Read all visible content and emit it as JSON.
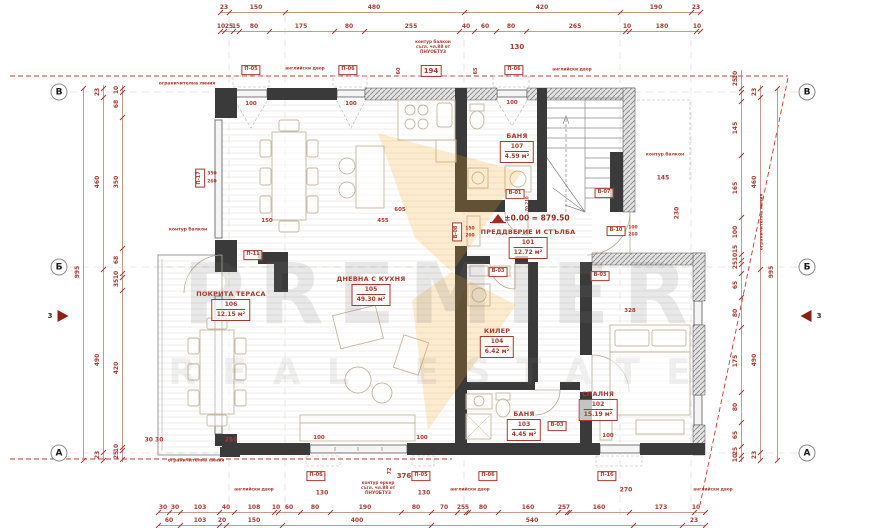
{
  "watermark": {
    "line1": "PREMIER",
    "line2": "REAL ESTATE",
    "accent_color": "#f2a71b"
  },
  "level_mark": "±0.00 = 879.50",
  "rooms": [
    {
      "name": "ПРЕДДВЕРИЕ И СТЪЛБА",
      "number": "101",
      "area": "12.72 м²",
      "x": 528,
      "y": 228
    },
    {
      "name": "СПАЛНЯ",
      "number": "102",
      "area": "15.19 м²",
      "x": 598,
      "y": 390
    },
    {
      "name": "БАНЯ",
      "number": "103",
      "area": "4.45 м²",
      "x": 524,
      "y": 410
    },
    {
      "name": "КИЛЕР",
      "number": "104",
      "area": "6.42 м²",
      "x": 497,
      "y": 327
    },
    {
      "name": "ДНЕВНА С КУХНЯ",
      "number": "105",
      "area": "49.30 м²",
      "x": 371,
      "y": 275
    },
    {
      "name": "ПОКРИТА ТЕРАСА",
      "number": "106",
      "area": "12.15 м²",
      "x": 231,
      "y": 290
    },
    {
      "name": "БАНЯ",
      "number": "107",
      "area": "4.59 м²",
      "x": 517,
      "y": 132
    }
  ],
  "grid_markers": [
    {
      "letter": "В",
      "x": 59,
      "y": 92
    },
    {
      "letter": "Б",
      "x": 59,
      "y": 267
    },
    {
      "letter": "А",
      "x": 59,
      "y": 453
    },
    {
      "letter": "В",
      "x": 807,
      "y": 92
    },
    {
      "letter": "Б",
      "x": 807,
      "y": 267
    },
    {
      "letter": "А",
      "x": 807,
      "y": 453
    }
  ],
  "section_markers": [
    {
      "label": "3",
      "x": 63,
      "y": 316,
      "dir": "right",
      "lx": 50,
      "ly": 316
    },
    {
      "label": "3",
      "x": 806,
      "y": 316,
      "dir": "left",
      "lx": 819,
      "ly": 316
    }
  ],
  "dims": [
    {
      "name": "dim-top-row1",
      "orient": "h",
      "pos": 12,
      "from": 220,
      "to": 700,
      "ticks": [
        220,
        229,
        285,
        464,
        620,
        691,
        700
      ],
      "labels": [
        {
          "p": 224,
          "v": "23"
        },
        {
          "p": 256,
          "v": "150"
        },
        {
          "p": 374,
          "v": "480"
        },
        {
          "p": 542,
          "v": "420"
        },
        {
          "p": 656,
          "v": "190"
        },
        {
          "p": 696,
          "v": "23"
        }
      ]
    },
    {
      "name": "dim-top-row2",
      "orient": "h",
      "pos": 31,
      "from": 220,
      "to": 700,
      "ticks": [
        220,
        224,
        233,
        239,
        269,
        334,
        364,
        459,
        474,
        496,
        526,
        625,
        629,
        696,
        700
      ],
      "labels": [
        {
          "p": 221,
          "v": "10"
        },
        {
          "p": 229,
          "v": "25"
        },
        {
          "p": 236,
          "v": "15"
        },
        {
          "p": 254,
          "v": "80"
        },
        {
          "p": 301,
          "v": "175"
        },
        {
          "p": 349,
          "v": "80"
        },
        {
          "p": 411,
          "v": "255"
        },
        {
          "p": 466,
          "v": "40"
        },
        {
          "p": 485,
          "v": "60"
        },
        {
          "p": 511,
          "v": "80"
        },
        {
          "p": 575,
          "v": "265"
        },
        {
          "p": 627,
          "v": "10"
        },
        {
          "p": 662,
          "v": "180"
        },
        {
          "p": 697,
          "v": "10"
        }
      ]
    },
    {
      "name": "dim-bottom-row1",
      "orient": "h",
      "pos": 512,
      "from": 158,
      "to": 705,
      "ticks": [
        158,
        169,
        180,
        219,
        234,
        274,
        278,
        300,
        330,
        401,
        431,
        457,
        466,
        468,
        498,
        558,
        567,
        569,
        629,
        694,
        705
      ],
      "labels": [
        {
          "p": 163,
          "v": "30"
        },
        {
          "p": 175,
          "v": "30"
        },
        {
          "p": 200,
          "v": "103"
        },
        {
          "p": 226,
          "v": "40"
        },
        {
          "p": 254,
          "v": "108"
        },
        {
          "p": 276,
          "v": "10"
        },
        {
          "p": 289,
          "v": "60"
        },
        {
          "p": 315,
          "v": "80"
        },
        {
          "p": 365,
          "v": "190"
        },
        {
          "p": 416,
          "v": "80"
        },
        {
          "p": 444,
          "v": "70"
        },
        {
          "p": 461,
          "v": "25"
        },
        {
          "p": 467,
          "v": "5"
        },
        {
          "p": 483,
          "v": "80"
        },
        {
          "p": 528,
          "v": "160"
        },
        {
          "p": 562,
          "v": "25"
        },
        {
          "p": 568,
          "v": "7"
        },
        {
          "p": 599,
          "v": "160"
        },
        {
          "p": 661,
          "v": "173"
        },
        {
          "p": 696,
          "v": "10"
        }
      ]
    },
    {
      "name": "dim-bottom-row2",
      "orient": "h",
      "pos": 525,
      "from": 158,
      "to": 705,
      "ticks": [
        158,
        180,
        219,
        226,
        282,
        431,
        633,
        682,
        705
      ],
      "labels": [
        {
          "p": 169,
          "v": "60"
        },
        {
          "p": 200,
          "v": "103"
        },
        {
          "p": 222,
          "v": "20"
        },
        {
          "p": 254,
          "v": "150"
        },
        {
          "p": 357,
          "v": "400"
        },
        {
          "p": 532,
          "v": "540"
        },
        {
          "p": 694,
          "v": "23"
        }
      ]
    },
    {
      "name": "dim-left-total",
      "orient": "v",
      "pos": 83,
      "from": 88,
      "to": 460,
      "ticks": [
        88,
        460
      ],
      "labels": [
        {
          "p": 272,
          "v": "995"
        }
      ]
    },
    {
      "name": "dim-left-mid",
      "orient": "v",
      "pos": 103,
      "from": 85,
      "to": 460,
      "ticks": [
        88,
        97,
        269,
        452,
        460
      ],
      "labels": [
        {
          "p": 92,
          "v": "23"
        },
        {
          "p": 182,
          "v": "460"
        },
        {
          "p": 360,
          "v": "490"
        },
        {
          "p": 455,
          "v": "23"
        }
      ]
    },
    {
      "name": "dim-left-inner",
      "orient": "v",
      "pos": 122,
      "from": 85,
      "to": 462,
      "ticks": [
        88,
        92,
        117,
        248,
        273,
        277,
        290,
        447,
        450,
        459
      ],
      "labels": [
        {
          "p": 90,
          "v": "10"
        },
        {
          "p": 104,
          "v": "68"
        },
        {
          "p": 182,
          "v": "350"
        },
        {
          "p": 260,
          "v": "68"
        },
        {
          "p": 275,
          "v": "10"
        },
        {
          "p": 283,
          "v": "35"
        },
        {
          "p": 368,
          "v": "420"
        },
        {
          "p": 448,
          "v": "10"
        },
        {
          "p": 455,
          "v": "25"
        }
      ]
    },
    {
      "name": "dim-right-inner",
      "orient": "v",
      "pos": 741,
      "from": 70,
      "to": 462,
      "ticks": [
        88,
        92,
        101,
        155,
        217,
        254,
        260,
        264,
        273,
        297,
        327,
        392,
        422,
        446,
        455,
        459
      ],
      "labels": [
        {
          "p": 75,
          "v": "10"
        },
        {
          "p": 82,
          "v": "25"
        },
        {
          "p": 128,
          "v": "145"
        },
        {
          "p": 188,
          "v": "165"
        },
        {
          "p": 232,
          "v": "100"
        },
        {
          "p": 249,
          "v": "15"
        },
        {
          "p": 257,
          "v": "10"
        },
        {
          "p": 265,
          "v": "25"
        },
        {
          "p": 285,
          "v": "65"
        },
        {
          "p": 313,
          "v": "80"
        },
        {
          "p": 361,
          "v": "175"
        },
        {
          "p": 407,
          "v": "80"
        },
        {
          "p": 435,
          "v": "65"
        },
        {
          "p": 451,
          "v": "25"
        },
        {
          "p": 458,
          "v": "10"
        }
      ]
    },
    {
      "name": "dim-right-mid",
      "orient": "v",
      "pos": 760,
      "from": 85,
      "to": 460,
      "ticks": [
        88,
        97,
        269,
        452,
        460
      ],
      "labels": [
        {
          "p": 92,
          "v": "23"
        },
        {
          "p": 182,
          "v": "460"
        },
        {
          "p": 360,
          "v": "490"
        },
        {
          "p": 455,
          "v": "23"
        }
      ]
    },
    {
      "name": "dim-right-total",
      "orient": "v",
      "pos": 777,
      "from": 88,
      "to": 460,
      "ticks": [
        88,
        460
      ],
      "labels": [
        {
          "p": 272,
          "v": "995"
        }
      ]
    }
  ],
  "annotations": [
    {
      "t": "ограничителна линия",
      "x": 187,
      "y": 84,
      "s": 4.5
    },
    {
      "t": "ограничителна линия",
      "x": 196,
      "y": 461,
      "s": 4.5
    },
    {
      "t": "ограничителна линия",
      "x": 762,
      "y": 222,
      "s": 4.5,
      "rot": true
    },
    {
      "t": "контур балкон",
      "x": 188,
      "y": 230,
      "s": 4.5
    },
    {
      "t": "контур балкон",
      "x": 665,
      "y": 155,
      "s": 4.5
    },
    {
      "t": "контур балкон\nсъгл. чл.88 от\nПНУОБТУЗ",
      "x": 433,
      "y": 47,
      "s": 4.2
    },
    {
      "t": "контур еркер\nсъгл. чл.88 от\nПНУОБТУЗ",
      "x": 378,
      "y": 488,
      "s": 4.2
    },
    {
      "t": "английски двор",
      "x": 305,
      "y": 70,
      "s": 4.3
    },
    {
      "t": "английски двор",
      "x": 572,
      "y": 71,
      "s": 4.3
    },
    {
      "t": "английски двор",
      "x": 254,
      "y": 491,
      "s": 4.3
    },
    {
      "t": "английски двор",
      "x": 470,
      "y": 491,
      "s": 4.3
    },
    {
      "t": "английски двор",
      "x": 713,
      "y": 491,
      "s": 4.3
    },
    {
      "t": "±0.00 = 879.50",
      "x": 537,
      "y": 219,
      "s": 7.5,
      "dark": true
    },
    {
      "t": "194",
      "x": 431,
      "y": 71,
      "s": 7,
      "box": true
    },
    {
      "t": "130",
      "x": 517,
      "y": 47,
      "s": 7
    },
    {
      "t": "130",
      "x": 322,
      "y": 494,
      "s": 6
    },
    {
      "t": "130",
      "x": 424,
      "y": 494,
      "s": 6
    },
    {
      "t": "376",
      "x": 404,
      "y": 476,
      "s": 7
    },
    {
      "t": "72",
      "x": 391,
      "y": 471,
      "s": 5,
      "rot": true
    },
    {
      "t": "270",
      "x": 626,
      "y": 491,
      "s": 6
    },
    {
      "t": "250",
      "x": 231,
      "y": 441,
      "s": 6
    },
    {
      "t": "30 30",
      "x": 154,
      "y": 441,
      "s": 6
    },
    {
      "t": "145",
      "x": 663,
      "y": 179,
      "s": 6
    },
    {
      "t": "230",
      "x": 678,
      "y": 213,
      "s": 6,
      "rot": true
    },
    {
      "t": "60",
      "x": 400,
      "y": 71,
      "s": 5,
      "rot": true
    },
    {
      "t": "65",
      "x": 477,
      "y": 71,
      "s": 5,
      "rot": true
    },
    {
      "t": "100",
      "x": 251,
      "y": 104,
      "s": 5.5
    },
    {
      "t": "100",
      "x": 351,
      "y": 104,
      "s": 5.5
    },
    {
      "t": "100",
      "x": 512,
      "y": 103,
      "s": 5.5
    },
    {
      "t": "100",
      "x": 319,
      "y": 438,
      "s": 5.5
    },
    {
      "t": "100",
      "x": 422,
      "y": 438,
      "s": 5.5
    },
    {
      "t": "100",
      "x": 608,
      "y": 436,
      "s": 5.5
    },
    {
      "t": "605",
      "x": 400,
      "y": 210,
      "s": 5.5
    },
    {
      "t": "455",
      "x": 383,
      "y": 221,
      "s": 5.5
    },
    {
      "t": "150",
      "x": 267,
      "y": 221,
      "s": 5.5
    },
    {
      "t": "328",
      "x": 630,
      "y": 311,
      "s": 5.5
    },
    {
      "t": "П-05",
      "x": 251,
      "y": 70,
      "s": 5,
      "box": true
    },
    {
      "t": "П-06",
      "x": 348,
      "y": 70,
      "s": 5,
      "box": true
    },
    {
      "t": "П-06",
      "x": 514,
      "y": 70,
      "s": 5,
      "box": true
    },
    {
      "t": "П-17",
      "x": 200,
      "y": 178,
      "s": 5,
      "box": true,
      "rot": true
    },
    {
      "t": "350",
      "x": 212,
      "y": 174,
      "s": 4.5
    },
    {
      "t": "260",
      "x": 212,
      "y": 182,
      "s": 4.5
    },
    {
      "t": "П-11",
      "x": 253,
      "y": 255,
      "s": 5,
      "box": true
    },
    {
      "t": "В-01",
      "x": 515,
      "y": 194,
      "s": 5,
      "box": true
    },
    {
      "t": "70 210",
      "x": 528,
      "y": 204,
      "s": 4,
      "rot": true
    },
    {
      "t": "В-07",
      "x": 604,
      "y": 193,
      "s": 5,
      "box": true
    },
    {
      "t": "В-10",
      "x": 616,
      "y": 231,
      "s": 5,
      "box": true
    },
    {
      "t": "100",
      "x": 633,
      "y": 228,
      "s": 4.5
    },
    {
      "t": "260",
      "x": 633,
      "y": 235,
      "s": 4.5
    },
    {
      "t": "В-08",
      "x": 457,
      "y": 232,
      "s": 5,
      "box": true,
      "rot": true
    },
    {
      "t": "150",
      "x": 470,
      "y": 229,
      "s": 4.5
    },
    {
      "t": "200",
      "x": 470,
      "y": 236,
      "s": 4.5
    },
    {
      "t": "В-03",
      "x": 498,
      "y": 272,
      "s": 5,
      "box": true
    },
    {
      "t": "В-03",
      "x": 600,
      "y": 276,
      "s": 5,
      "box": true
    },
    {
      "t": "В-03",
      "x": 557,
      "y": 426,
      "s": 5,
      "box": true
    },
    {
      "t": "П-06",
      "x": 316,
      "y": 476,
      "s": 5,
      "box": true
    },
    {
      "t": "П-05",
      "x": 421,
      "y": 476,
      "s": 5,
      "box": true
    },
    {
      "t": "П-06",
      "x": 488,
      "y": 476,
      "s": 5,
      "box": true
    },
    {
      "t": "П-16",
      "x": 607,
      "y": 476,
      "s": 5,
      "box": true
    }
  ]
}
